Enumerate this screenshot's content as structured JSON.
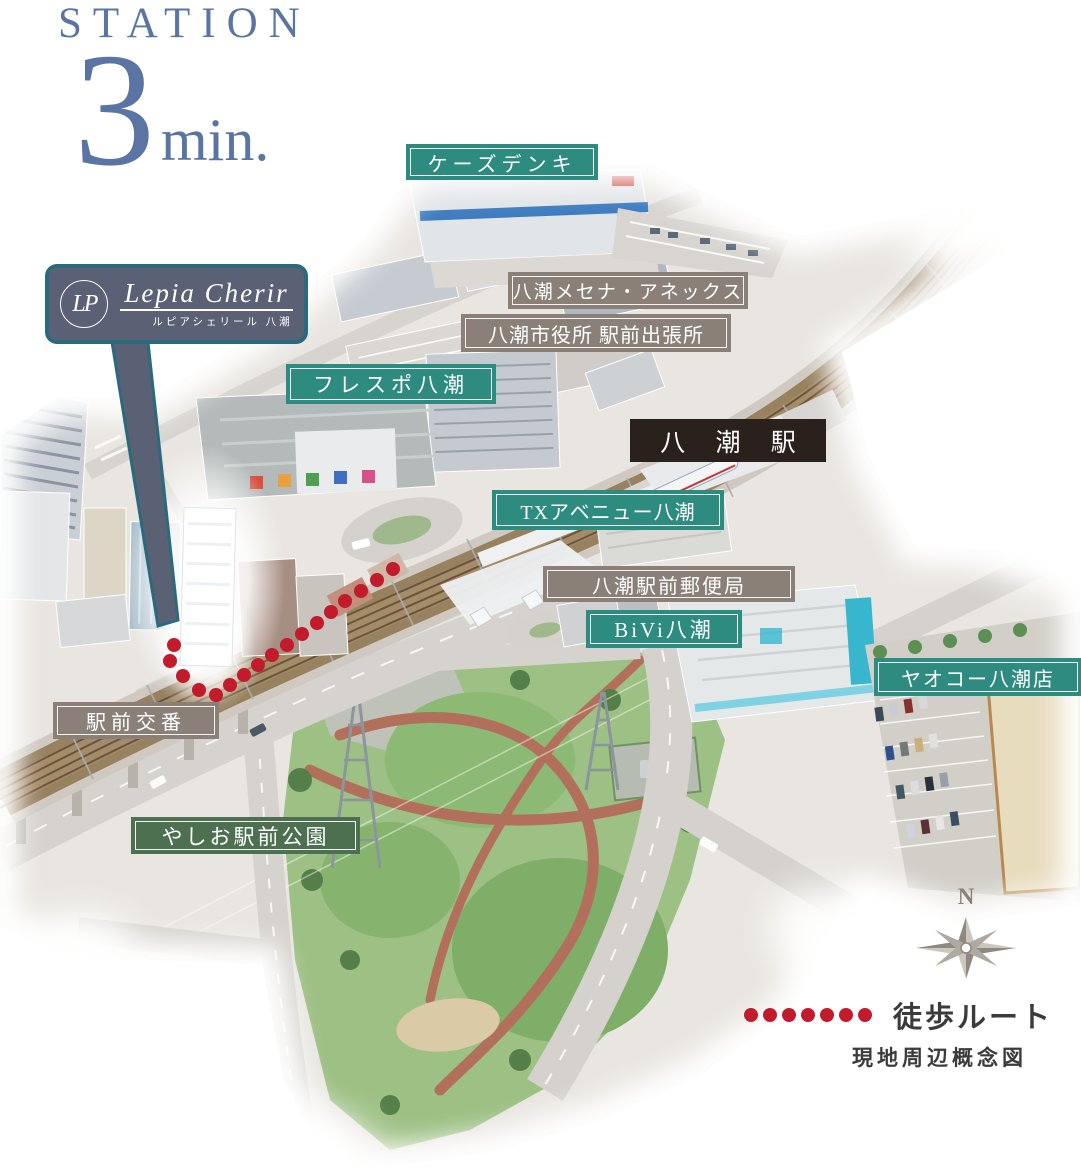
{
  "title": {
    "station": "STATION",
    "big": "3",
    "unit": "min."
  },
  "callout": {
    "monogram": "LP",
    "brand": "Lepia Cherir",
    "sub": "ルピアシェリール 八潮"
  },
  "labels": {
    "ksdenki": {
      "text": "ケーズデンキ",
      "type": "teal"
    },
    "mecenat": {
      "text": "八潮メセナ・アネックス",
      "type": "taupe"
    },
    "cityoffice": {
      "text": "八潮市役所 駅前出張所",
      "type": "taupe"
    },
    "frespo": {
      "text": "フレスポ八潮",
      "type": "teal"
    },
    "station": {
      "text": "八 潮 駅",
      "type": "dark"
    },
    "txavenue": {
      "text": "TXアベニュー八潮",
      "type": "teal"
    },
    "postoffice": {
      "text": "八潮駅前郵便局",
      "type": "taupe"
    },
    "bivi": {
      "text": "BiVi八潮",
      "type": "teal"
    },
    "yaoko": {
      "text": "ヤオコー八潮店",
      "type": "teal"
    },
    "koban": {
      "text": "駅前交番",
      "type": "taupe"
    },
    "park": {
      "text": "やしお駅前公園",
      "type": "green"
    }
  },
  "legend": {
    "walk_route": "徒歩ルート",
    "caption": "現地周辺概念図"
  },
  "compass": {
    "north": "N"
  },
  "colors": {
    "teal": "#2e8b80",
    "taupe": "#8a8078",
    "dark": "#2b211c",
    "green": "#4c7050",
    "blue": "#5a74a4",
    "red": "#c21b2b",
    "slate": "#5b6175",
    "tealBorder": "#2b6a7c"
  }
}
